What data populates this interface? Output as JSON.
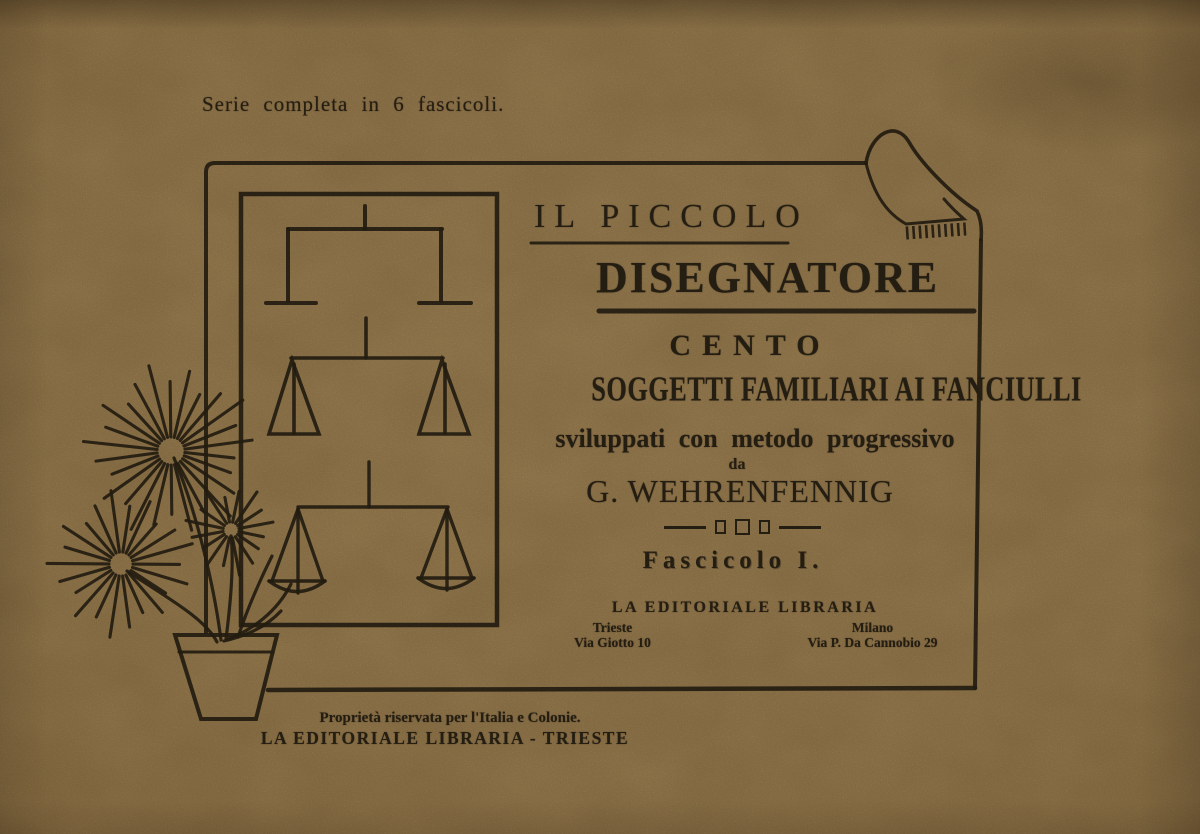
{
  "colors": {
    "paper": "#a68a5b",
    "ink": "#2d2517"
  },
  "header": {
    "series_note": "Serie completa in 6 fascicoli."
  },
  "cover": {
    "title_line1": "IL PICCOLO",
    "title_line2": "DISEGNATORE",
    "count_word": "CENTO",
    "subject_line": "SOGGETTI FAMILIARI AI FANCIULLI",
    "method_line": "sviluppati con metodo progressivo",
    "by_word": "da",
    "author": "G. WEHRENFENNIG",
    "issue_label": "Fascicolo I.",
    "publisher": "LA EDITORIALE LIBRARIA",
    "offices": [
      {
        "city": "Trieste",
        "address": "Via Giotto 10"
      },
      {
        "city": "Milano",
        "address": "Via P. Da Cannobio 29"
      }
    ]
  },
  "footer": {
    "rights_line": "Proprietà riservata per l'Italia e Colonie.",
    "imprint_line": "LA EDITORIALE LIBRARIA - TRIESTE"
  },
  "illustration": {
    "framed_picture": "balance-scales-progressive-drawing",
    "plant": "potted-palm-plant-drawing",
    "page_curl": "folded-page-corner"
  }
}
